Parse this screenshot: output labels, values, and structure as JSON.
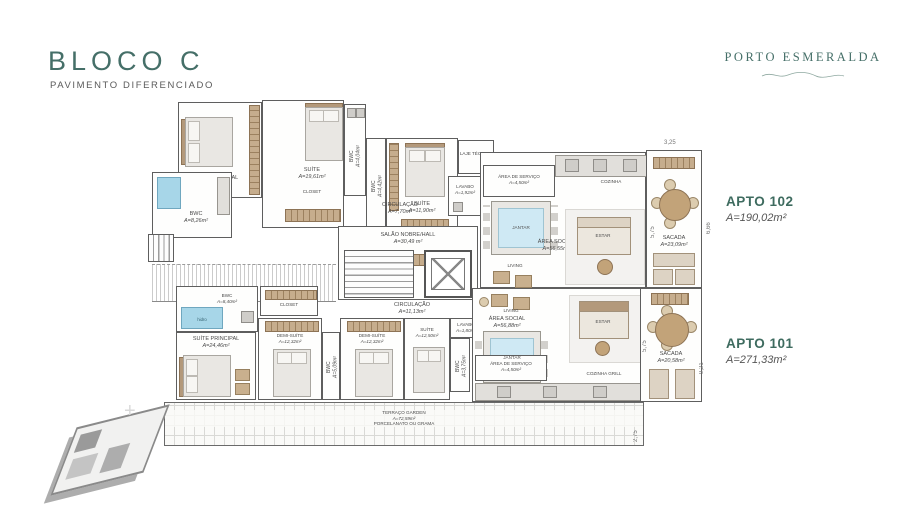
{
  "header": {
    "title": "BLOCO C",
    "subtitle": "PAVIMENTO DIFERENCIADO"
  },
  "brand": {
    "name": "PORTO ESMERALDA"
  },
  "apto": {
    "a102": {
      "label": "APTO 102",
      "area": "A=190,02m²"
    },
    "a101": {
      "label": "APTO 101",
      "area": "A=271,33m²"
    }
  },
  "r102": {
    "suite_principal": {
      "name": "SUÍTE PRINCIPAL",
      "area": "A=29,39m²"
    },
    "suite1": {
      "name": "SUÍTE",
      "area": "A=19,61m²"
    },
    "bwc_principal": {
      "name": "BWC",
      "area": "A=8,26m²"
    },
    "bwc1": {
      "name": "BWC",
      "area": "A=4,04m²"
    },
    "bwc2": {
      "name": "BWC",
      "area": "A=4,42m²"
    },
    "suite2": {
      "name": "SUÍTE",
      "area": "A=11,90m²"
    },
    "laje": {
      "name": "LAJE TÉCNICA"
    },
    "lavabo": {
      "name": "LAVABO",
      "area": "A=1,92m²"
    },
    "servico": {
      "name": "ÁREA DE SERVIÇO",
      "area": "A=4,50m²"
    },
    "cozinha": {
      "name": "COZINHA"
    },
    "circulacao": {
      "name": "CIRCULAÇÃO",
      "area": "A=7,70m²"
    },
    "hall": {
      "name": "SALÃO NOBRE/HALL",
      "area": "A=30,49 m²"
    },
    "social": {
      "name": "ÁREA SOCIAL",
      "area": "A=56,55m²"
    },
    "jantar": "JANTAR",
    "living": "LIVING",
    "estar": "ESTAR",
    "sacada": {
      "name": "SACADA",
      "area": "A=23,09m²"
    }
  },
  "r101": {
    "bwc_hidro": {
      "name": "BWC",
      "area": "A=8,40m²"
    },
    "hidro": "hidro",
    "suite_principal": {
      "name": "SUÍTE PRINCIPAL",
      "area": "A=24,46m²"
    },
    "demi1": {
      "name": "DEMI-SUÍTE",
      "area": "A=12,32m²"
    },
    "demi2": {
      "name": "DEMI-SUÍTE",
      "area": "A=12,32m²"
    },
    "bwc5": {
      "name": "BWC",
      "area": "A=5,09m²"
    },
    "suite": {
      "name": "SUÍTE",
      "area": "A=12,50m²"
    },
    "lavabo": {
      "name": "LAVABO",
      "area": "A=1,80m²"
    },
    "bwc3": {
      "name": "BWC",
      "area": "A=3,75m²"
    },
    "circulacao": {
      "name": "CIRCULAÇÃO",
      "area": "A=11,13m²"
    },
    "social": {
      "name": "ÁREA SOCIAL",
      "area": "A=56,88m²"
    },
    "servico": {
      "name": "ÁREA DE SERVIÇO",
      "area": "A=4,50m²"
    },
    "cozinha": {
      "name": "COZINHA GRILL"
    },
    "jantar": "JANTAR",
    "living": "LIVING",
    "estar": "ESTAR",
    "sacada": {
      "name": "SACADA",
      "area": "A=20,58m²"
    },
    "terraco": {
      "name": "TERRAÇO GARDEN",
      "area": "A=72,59m²",
      "note": "PORCELANATO OU GRAMA"
    }
  },
  "labels": {
    "closet": "CLOSET"
  },
  "dims": {
    "d325": "3,25",
    "d666": "6,66",
    "d575a": "5,75",
    "d575b": "5,75",
    "d921": "9,21",
    "d275": "2,75"
  },
  "colors": {
    "accent": "#456F68",
    "text": "#555555",
    "wall": "#5E5E5E",
    "water": "#A7D6E8",
    "wood": "#B3997B"
  }
}
